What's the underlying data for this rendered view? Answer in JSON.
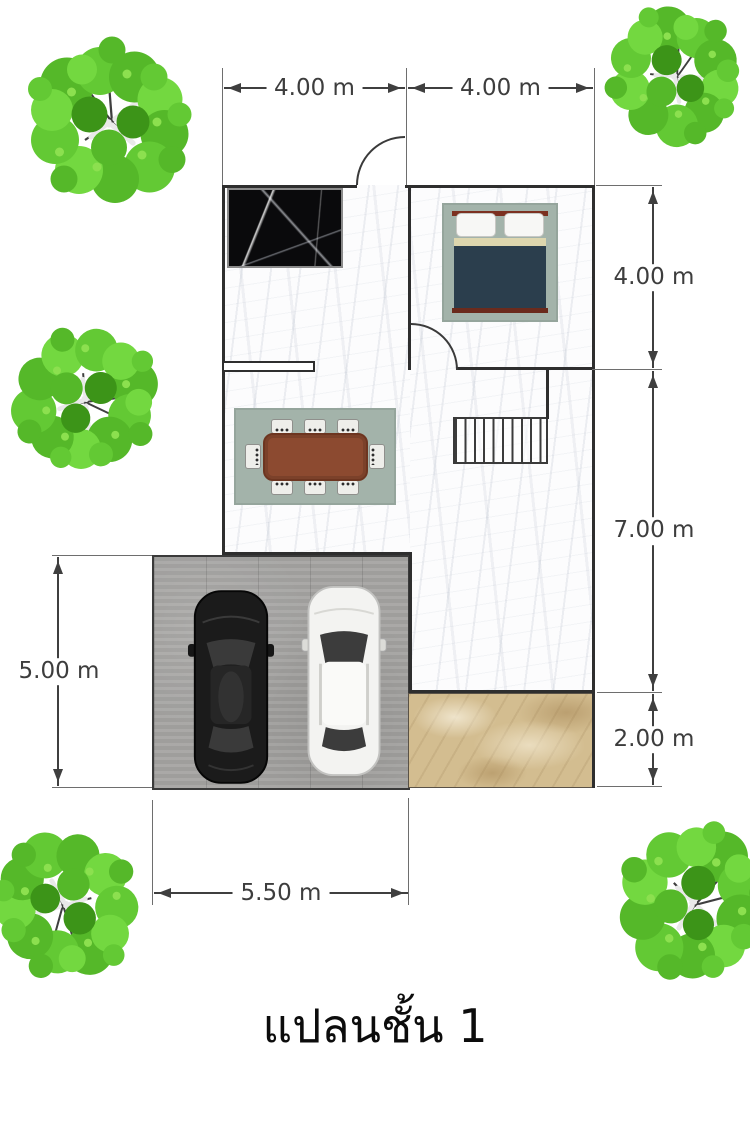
{
  "caption": {
    "text": "แปลนชั้น 1"
  },
  "dimensions": {
    "top_left": "4.00 m",
    "top_right": "4.00 m",
    "right_upper": "4.00 m",
    "right_middle": "7.00 m",
    "right_lower": "2.00 m",
    "left_side": "5.00 m",
    "bottom": "5.50 m"
  },
  "colors": {
    "dimension_text": "#3d3d3d",
    "wall": "#2e2e2e",
    "tree_green": "#5cb82a",
    "rug": "#a3b3aa",
    "dining_table": "#8c4a30",
    "bed_duvet": "#2b3e4d",
    "bed_headboard": "#7c3020",
    "porch_tile": "#d3bd90",
    "garage_concrete": "#a5a4a2",
    "kitchen_counter": "#0a0a0c",
    "car_black": "#1b1b1b",
    "car_white": "#f3f3f1"
  },
  "icons": {
    "tree": "tree-top-view-icon",
    "black_car": "black-sedan-top-view-icon",
    "white_car": "white-suv-top-view-icon",
    "bed": "double-bed-top-view-icon",
    "dining": "dining-table-8-chairs-icon",
    "stairs": "staircase-icon",
    "door_arc": "door-swing-arc-icon"
  }
}
